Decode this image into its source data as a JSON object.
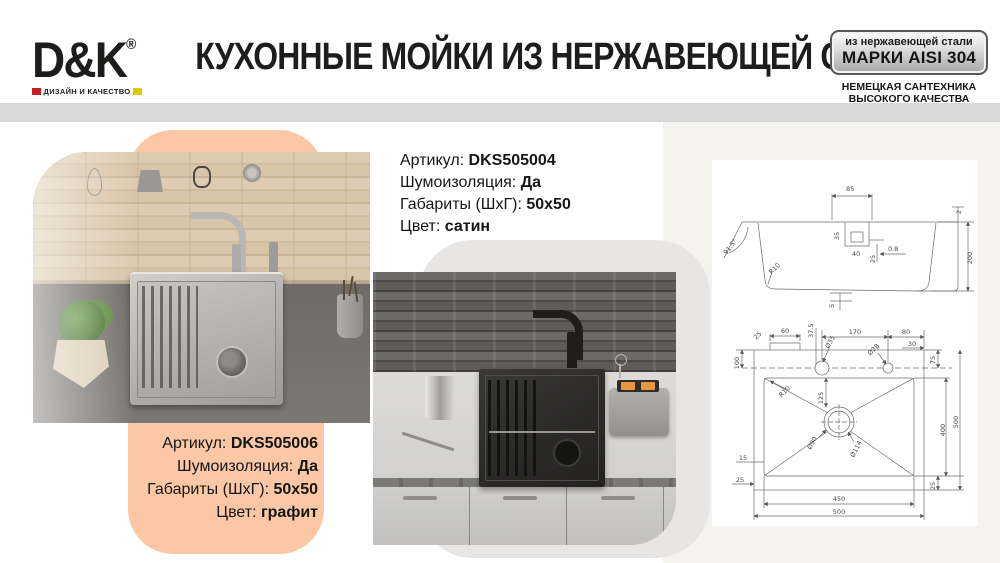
{
  "header": {
    "logo": {
      "text": "D&K",
      "reg": "®",
      "tagline": "ДИЗАЙН И КАЧЕСТВО"
    },
    "title": "КУХОННЫЕ МОЙКИ ИЗ НЕРЖАВЕЮЩЕЙ СТАЛИ",
    "badge": {
      "line1": "из нержавеющей стали",
      "line2": "МАРКИ AISI 304"
    },
    "subbadge": {
      "line1": "НЕМЕЦКАЯ САНТЕХНИКА",
      "line2": "ВЫСОКОГО КАЧЕСТВА"
    }
  },
  "products": [
    {
      "rows": [
        {
          "label": "Артикул:",
          "value": "DKS505004"
        },
        {
          "label": "Шумоизоляция:",
          "value": "Да"
        },
        {
          "label": "Габариты (ШхГ):",
          "value": "50х50"
        },
        {
          "label": "Цвет:",
          "value": "сатин"
        }
      ]
    },
    {
      "rows": [
        {
          "label": "Артикул:",
          "value": "DKS505006"
        },
        {
          "label": "Шумоизоляция:",
          "value": "Да"
        },
        {
          "label": "Габариты (ШхГ):",
          "value": "50х50"
        },
        {
          "label": "Цвет:",
          "value": "графит"
        }
      ]
    }
  ],
  "drawing": {
    "sec": {
      "d85": "85",
      "d35": "35",
      "d40": "40",
      "d25": "25",
      "d08": "0.8",
      "d2": "2",
      "d200": "200",
      "ang": "91.5°",
      "r10": "R10",
      "d5": "5"
    },
    "plan": {
      "c25": "25",
      "d60": "60",
      "d375": "37.5",
      "h35": "Ø35",
      "d170": "170",
      "h28": "Ø28",
      "d80": "80",
      "d30": "30",
      "d100": "100",
      "d75": "75",
      "r10": "R10",
      "d125": "125",
      "h90": "Ø90",
      "h114": "Ø114",
      "d15": "15",
      "l25": "25",
      "d400": "400",
      "r500": "500",
      "d450": "450",
      "b500": "500",
      "r25": "25"
    }
  },
  "colors": {
    "accent_peach": "#FBC7A4",
    "bar_gray": "#D8D8D8",
    "logo_red": "#C41E25",
    "logo_yellow": "#DDC803",
    "panel_offwhite": "#F4F3F0",
    "card_gray": "#E7E6E4"
  }
}
